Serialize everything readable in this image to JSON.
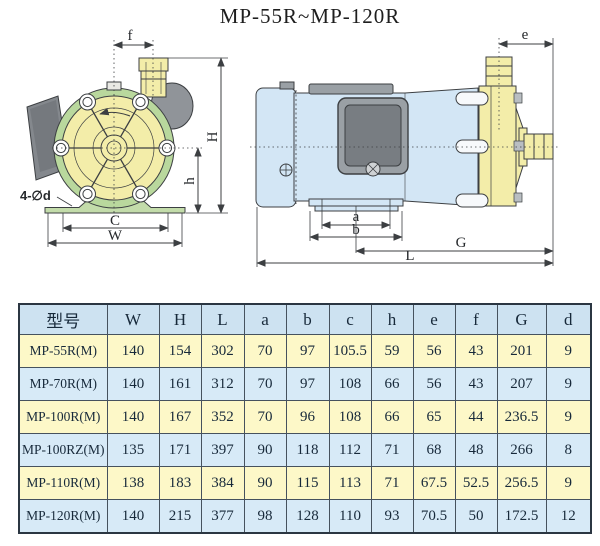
{
  "title": "MP-55R~MP-120R",
  "front_view": {
    "dim_f": "f",
    "dim_H": "H",
    "dim_h": "h",
    "dim_C": "C",
    "dim_W": "W",
    "holes_label": "4-∅d"
  },
  "side_view": {
    "dim_e": "e",
    "dim_a": "a",
    "dim_b": "b",
    "dim_G": "G",
    "dim_L": "L"
  },
  "colors": {
    "pump_yellow": "#f3eda9",
    "motor_blue": "#d3e6f5",
    "rim_green": "#b9d89d",
    "base_green": "#c3dcaa",
    "metal_gray": "#9aa0a5",
    "panel_gray": "#787d82",
    "line_dark": "#3c3f42",
    "row_yellow": "#fdf8c8",
    "row_blue": "#d7eaf7",
    "header_blue": "#cde2f1"
  },
  "table": {
    "columns": [
      "型号",
      "W",
      "H",
      "L",
      "a",
      "b",
      "c",
      "h",
      "e",
      "f",
      "G",
      "d"
    ],
    "rows": [
      [
        "MP-55R(M)",
        "140",
        "154",
        "302",
        "70",
        "97",
        "105.5",
        "59",
        "56",
        "43",
        "201",
        "9"
      ],
      [
        "MP-70R(M)",
        "140",
        "161",
        "312",
        "70",
        "97",
        "108",
        "66",
        "56",
        "43",
        "207",
        "9"
      ],
      [
        "MP-100R(M)",
        "140",
        "167",
        "352",
        "70",
        "96",
        "108",
        "66",
        "65",
        "44",
        "236.5",
        "9"
      ],
      [
        "MP-100RZ(M)",
        "135",
        "171",
        "397",
        "90",
        "118",
        "112",
        "71",
        "68",
        "48",
        "266",
        "8"
      ],
      [
        "MP-110R(M)",
        "138",
        "183",
        "384",
        "90",
        "115",
        "113",
        "71",
        "67.5",
        "52.5",
        "256.5",
        "9"
      ],
      [
        "MP-120R(M)",
        "140",
        "215",
        "377",
        "98",
        "128",
        "110",
        "93",
        "70.5",
        "50",
        "172.5",
        "12"
      ]
    ]
  }
}
